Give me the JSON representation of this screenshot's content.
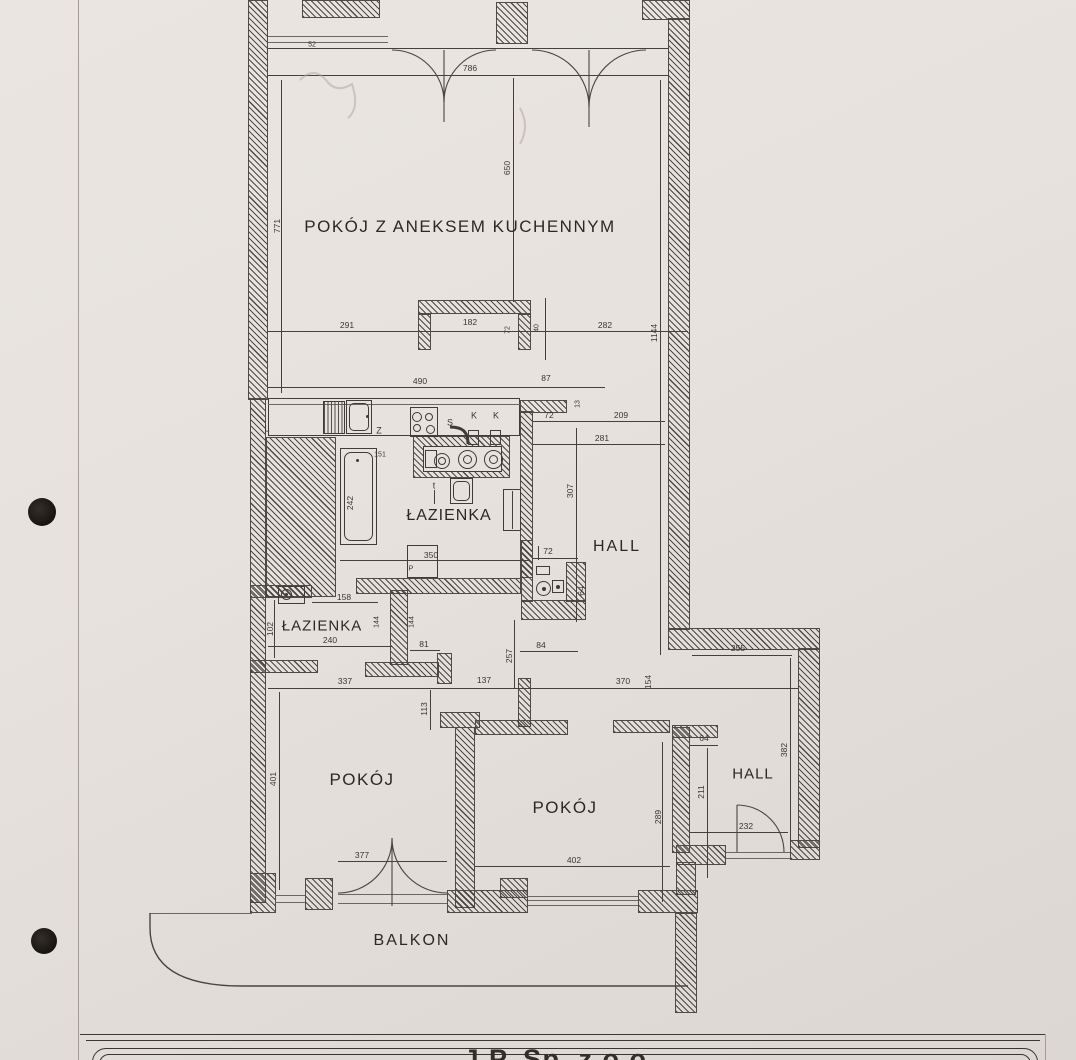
{
  "rooms": {
    "living": "POKÓJ Z ANEKSEM KUCHENNYM",
    "bath1": "ŁAZIENKA",
    "hall1": "HALL",
    "bath2": "ŁAZIENKA",
    "room_left": "POKÓJ",
    "room_right": "POKÓJ",
    "hall2": "HALL",
    "balcony": "BALKON"
  },
  "kitchen": {
    "l": "L",
    "z": "Z",
    "s": "S",
    "k": "K",
    "t": "t",
    "p": "P"
  },
  "dims": {
    "d786": "786",
    "d771": "771",
    "d650": "650",
    "d291": "291",
    "d182": "182",
    "d282": "282",
    "d72": "72",
    "d40": "40",
    "d1144": "1144",
    "d490": "490",
    "d87": "87",
    "d13": "13",
    "d209": "209",
    "d281": "281",
    "d307": "307",
    "d242": "242",
    "d151": "151",
    "d52": "52",
    "d350": "350",
    "d64": "64",
    "d84": "84",
    "d158": "158",
    "d102": "102",
    "d240": "240",
    "d81": "81",
    "d144": "144",
    "d337": "337",
    "d137": "137",
    "d113": "113",
    "d257": "257",
    "d370": "370",
    "d154": "154",
    "d255": "255",
    "d401": "401",
    "d377": "377",
    "d402": "402",
    "d289": "289",
    "d211": "211",
    "d232": "232",
    "d382": "382"
  },
  "footer": {
    "company": "J.P. Sp. z o.o."
  }
}
